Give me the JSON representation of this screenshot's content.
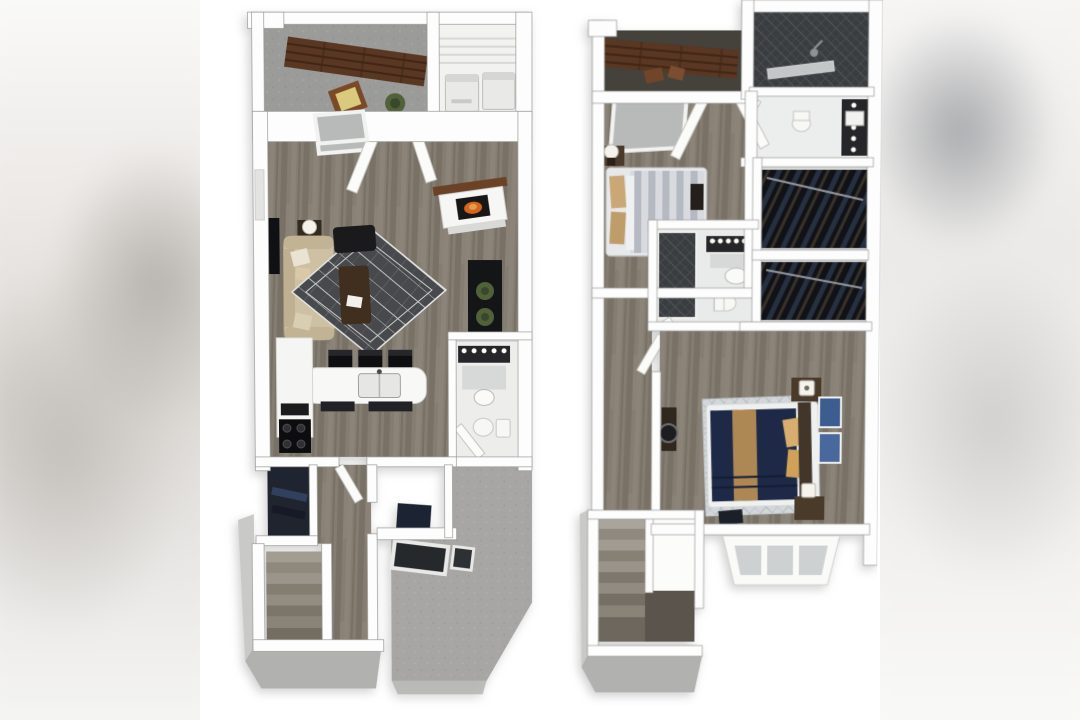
{
  "scene": {
    "type": "3d-floor-plan-rendering",
    "description": "Two-level apartment 3D floor plans side by side on a white background with blurred gray letterbox bands at left and right edges; no text is rendered in the image",
    "floors": [
      {
        "id": "first-floor",
        "position": "left",
        "rooms": [
          "patio",
          "laundry-closet",
          "living-room",
          "dining-area",
          "kitchen",
          "powder-room",
          "storage-closet",
          "entry-hall",
          "staircase",
          "entry-porch"
        ],
        "furniture": [
          "wood-fence",
          "patio-chair",
          "potted-plant",
          "washer",
          "dryer",
          "skylight-window",
          "french-doors",
          "fireplace",
          "wall-tv",
          "side-lamp",
          "tan-sofa",
          "throw-pillows",
          "charcoal-diamond-rug",
          "media-unit",
          "coffee-table",
          "console-with-plants",
          "three-bar-stools",
          "kitchen-island-with-sink",
          "counter-with-stove",
          "vanity-with-lights",
          "toilet",
          "entry-mat",
          "porch-windows",
          "stairs"
        ]
      },
      {
        "id": "second-floor",
        "position": "right",
        "rooms": [
          "balcony",
          "bedroom-2",
          "master-bathroom",
          "walk-in-shower",
          "closet-a",
          "closet-b",
          "hall-bathroom",
          "hallway",
          "master-bedroom",
          "staircase"
        ],
        "furniture": [
          "wood-fence",
          "balcony-chairs",
          "dark-tile-shower",
          "glass-panel",
          "vanity-with-lights",
          "toilet",
          "striped-bed",
          "tan-pillows",
          "nightstand-with-lamp",
          "dresser",
          "hanging-clothes",
          "navy-bed-with-tan-runner",
          "light-diamond-rug",
          "two-nightstands-with-cube-lamps",
          "round-mirror-dresser",
          "blue-wall-art",
          "foot-bench",
          "bay-window",
          "stairs"
        ]
      }
    ]
  },
  "colors": {
    "pageBg": "#ffffff",
    "bandLight": "#efeeec",
    "bandMid": "#d9d7d4",
    "bandDark": "#8f9094",
    "wall": "#fdfdfd",
    "wallEdge": "#9a9a98",
    "wallFaceLight": "#c9c9c7",
    "wallFaceDark": "#b1b1af",
    "woodBase": "#847d71",
    "woodDark": "#6f685d",
    "woodLight": "#948c7f",
    "concretePatio": "#9b9b99",
    "concretePorch": "#a7a6a4",
    "fenceBrown": "#5a3722",
    "fenceDark": "#3f2616",
    "balconyFloor": "#45413b",
    "sofaTan": "#cec0a2",
    "sofaShadow": "#b5a687",
    "pillowCream": "#eae3d2",
    "rugCharcoal": "#47494d",
    "rugLine": "#d8d8d6",
    "tableBrown": "#402e1e",
    "furnBlack": "#141517",
    "applianceWhite": "#e9e9e7",
    "islandWhite": "#f8f8f6",
    "plantGreen": "#51613a",
    "fireOrange": "#d2661f",
    "mantelBrown": "#6b4226",
    "tileDark": "#3a3d40",
    "tileLine": "#53575c",
    "bedStripeA": "#d9dadf",
    "bedStripeB": "#b5b9c2",
    "pillowTan": "#c9a876",
    "navyDuvet": "#1d2947",
    "runnerTan": "#ad8754",
    "rugLightBase": "#d3d7da",
    "rugLightLine": "#b2bac1",
    "nightWood": "#4a3a2a",
    "artBlue": "#3d5c90",
    "closetDark": "#101217",
    "windowGlass": "#b8bab9",
    "doorWhite": "#fbfbf9",
    "matNavy": "#1c2434",
    "landingDark": "#5a544c",
    "stepLight": "#a9a49c",
    "stepMid": "#8f897f"
  }
}
